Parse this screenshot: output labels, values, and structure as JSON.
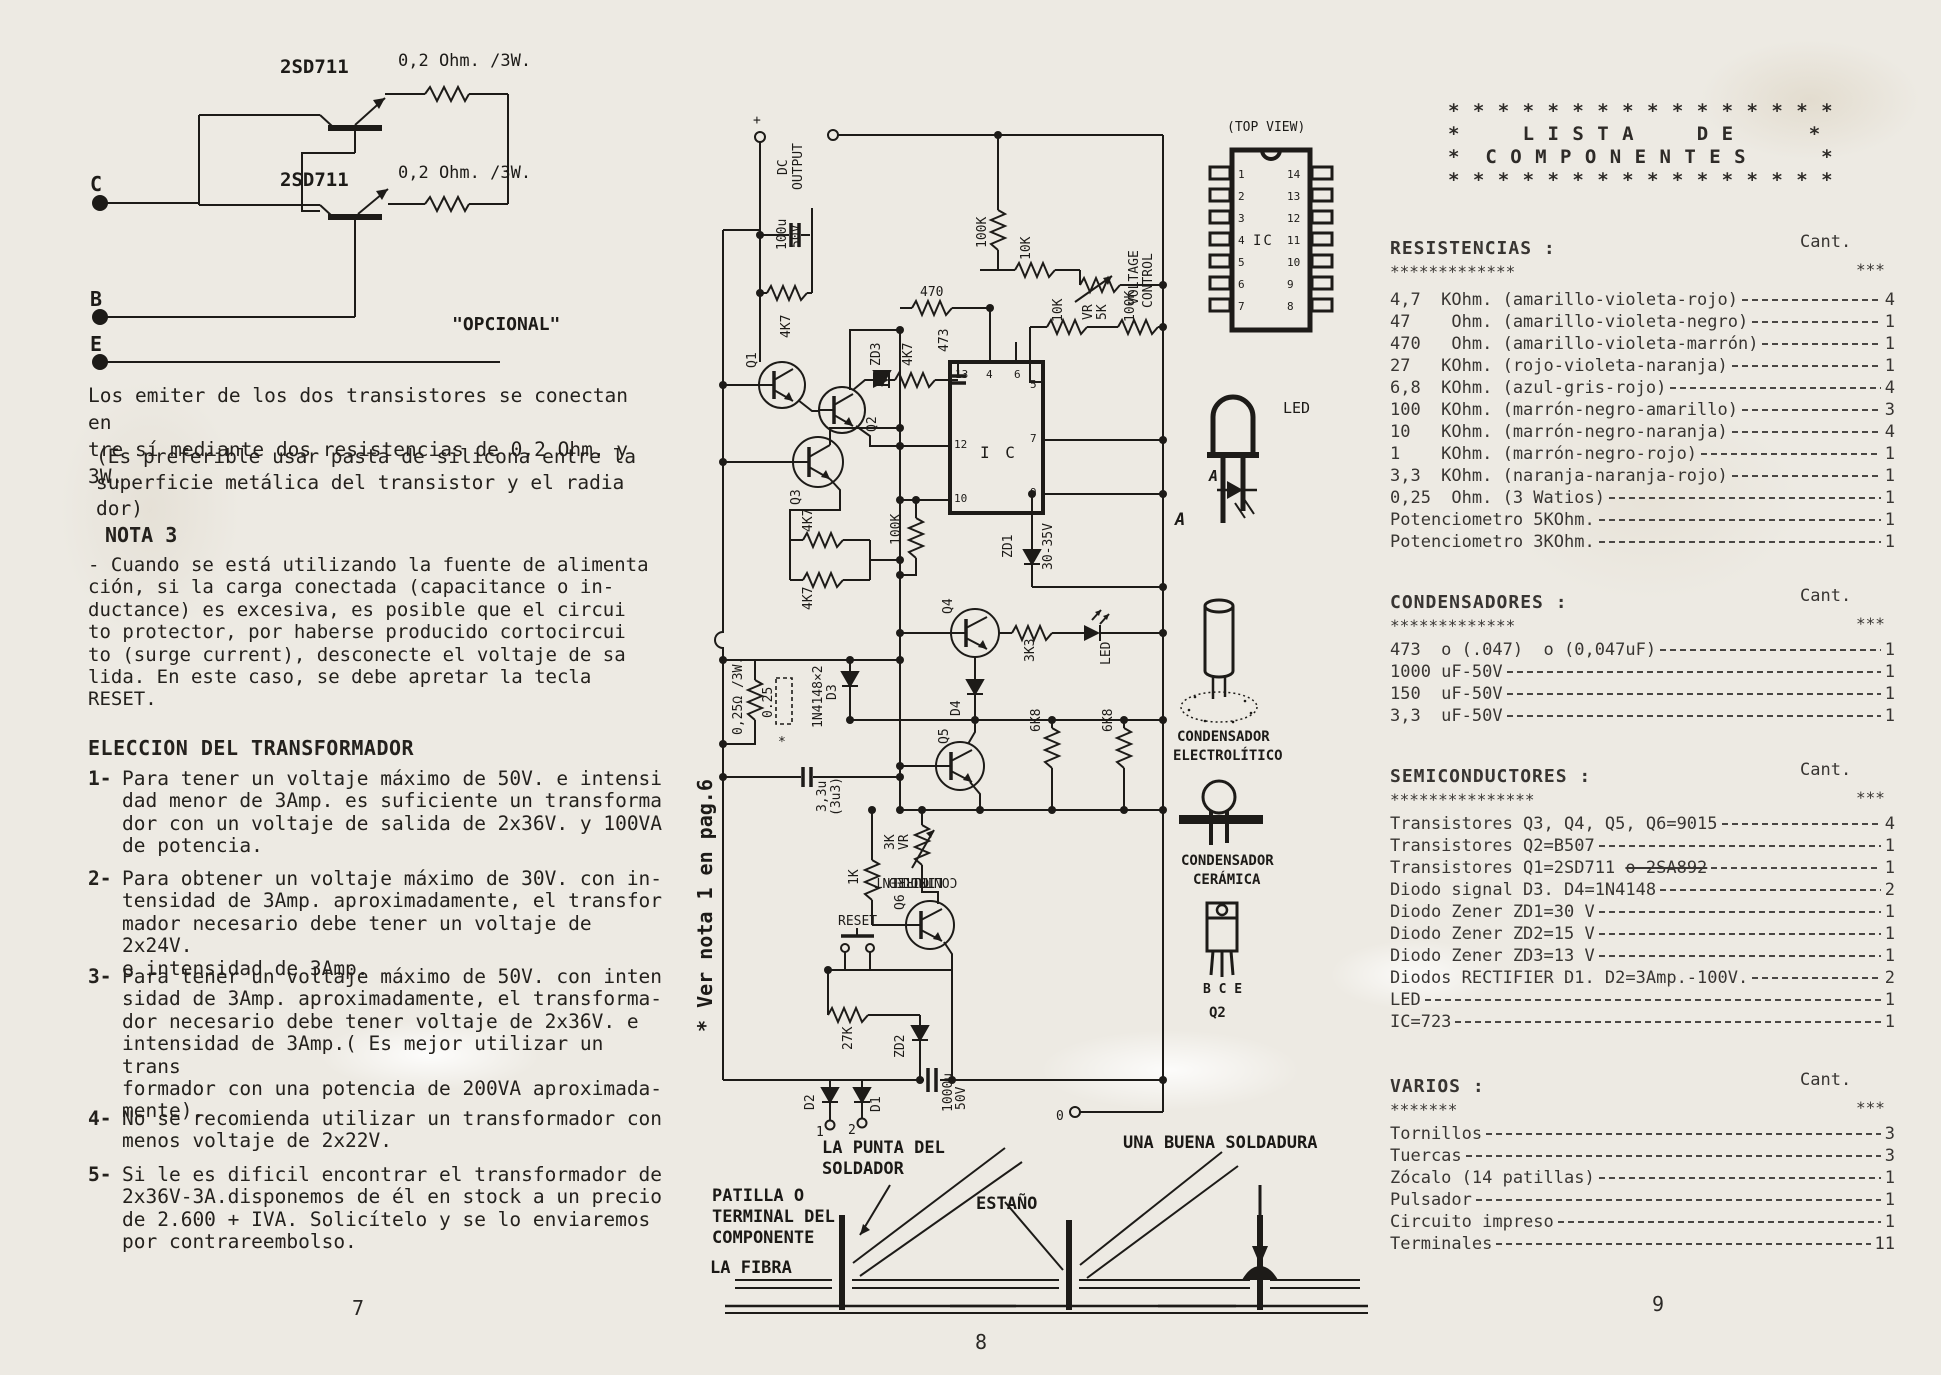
{
  "left_column": {
    "circuit": {
      "q_top": "2SD711",
      "q_bottom": "2SD711",
      "r_top": "0,2 Ohm. /3W.",
      "r_bottom": "0,2 Ohm. /3W.",
      "term_c": "C",
      "term_b": "B",
      "term_e": "E",
      "caption": "\"OPCIONAL\""
    },
    "para1": "Los emiter de los dos transistores se conectan en\ntre sí mediante dos resistencias de 0,2 Ohm. y 3W.",
    "para2": "(Es preferible usar pasta de silicona entre la\n superficie metálica del transistor y el radia\n dor)",
    "nota3_title": "NOTA 3",
    "nota3_body": "- Cuando se está utilizando la fuente de alimenta\n  ción, si la carga conectada (capacitance o in-\n  ductance) es excesiva, es posible que el circui\n  to protector, por haberse producido cortocircui\n  to (surge current), desconecte el voltaje de sa\n  lida. En este caso, se debe apretar la tecla\n  RESET.",
    "eleccion_title": "ELECCION DEL TRANSFORMADOR",
    "items": [
      {
        "num": "1-",
        "text": "Para tener un voltaje máximo de 50V. e intensi\ndad menor de 3Amp. es suficiente un transforma\ndor con un voltaje de salida de 2x36V. y 100VA\nde potencia."
      },
      {
        "num": "2-",
        "text": "Para obtener un voltaje máximo de 30V. con in-\ntensidad de 3Amp. aproximadamente, el transfor\nmador necesario debe tener un voltaje de 2x24V.\ne intensidad de 3Amp."
      },
      {
        "num": "3-",
        "text": "Para tener un voltaje máximo de 50V. con inten\nsidad de 3Amp. aproximadamente, el transforma-\ndor necesario debe tener voltaje de 2x36V. e\nintensidad de 3Amp.( Es mejor utilizar un trans\nformador con una potencia de 200VA aproximada-\nmente)."
      },
      {
        "num": "4-",
        "text": "No se recomienda utilizar un transformador con\nmenos voltaje de 2x22V."
      },
      {
        "num": "5-",
        "text": "Si le es dificil encontrar el transformador de\n2x36V-3A.disponemos de él en stock a un precio\nde 2.600 + IVA. Solicítelo y se lo enviaremos\npor contrareembolso."
      }
    ],
    "page_number": "7"
  },
  "schematic": {
    "labels": {
      "plus": "+",
      "dc1": "DC",
      "dc2": "OUTPUT",
      "c100u": "100u",
      "c100v": "50V",
      "r4k7_top": "4K7",
      "q1": "Q1",
      "q2": "Q2",
      "zd3": "ZD3",
      "r4k7_zd3": "4K7",
      "c473": "473",
      "r470": "470",
      "r100k_a": "100K",
      "r10k_a": "10K",
      "volt1": "VOLTAGE",
      "volt2": "CONTROL",
      "vr_a": "VR",
      "vr_a2": "5K",
      "r100k_b": "100K",
      "r10k_b": "10K",
      "ic": "I C",
      "p13": "13",
      "p4": "4",
      "p6": "6",
      "p5": "5",
      "p7": "7",
      "p9": "9",
      "p12": "12",
      "p10": "10",
      "q3": "Q3",
      "r4k7_a": "4K7",
      "r4k7_b": "4K7",
      "r100k_c": "100K",
      "zd1": "ZD1",
      "zd1v": "30-35V",
      "q4": "Q4",
      "r3k3": "3K3",
      "led": "LED",
      "r6k8_a": "6K8",
      "r6k8_b": "6K8",
      "q5": "Q5",
      "c33u": "3,3u",
      "c33u2": "(3u3)",
      "vr_b": "VR",
      "vr_b2": "3K",
      "r1k": "1K",
      "cur1": "CURRENT",
      "cur2": "LIMITED",
      "cur3": "CONTROL",
      "q6": "Q6",
      "reset": "RESET",
      "r27k": "27K",
      "zd2": "ZD2",
      "r025": "0,25Ω /3W.",
      "r025b": "0.25",
      "ast": "*",
      "d3lbl": "1N4148×2",
      "d3": "D3",
      "d4": "D4",
      "d2": "D2",
      "d1": "D1",
      "t1": "1",
      "t2": "2",
      "c1000": "1000u",
      "c1000v": "50V",
      "t0": "0",
      "note": "* Ver nota 1 en pag.6"
    }
  },
  "pictograms": {
    "top_view": "(TOP VIEW)",
    "ic": "IC",
    "pins_left": [
      "1",
      "2",
      "3",
      "4",
      "5",
      "6",
      "7"
    ],
    "pins_right": [
      "14",
      "13",
      "12",
      "11",
      "10",
      "9",
      "8"
    ],
    "led": "LED",
    "a1": "A",
    "a2": "A",
    "elec1": "CONDENSADOR",
    "elec2": "ELECTROLÍTICO",
    "cer1": "CONDENSADOR",
    "cer2": "CERÁMICA",
    "bce": "B C E",
    "q2": "Q2"
  },
  "soldering": {
    "tip": "LA PUNTA DEL\nSOLDADOR",
    "lead": "PATILLA O\nTERMINAL DEL\nCOMPONENTE",
    "tin": "ESTAÑO",
    "fiber": "LA FIBRA",
    "good": "UNA BUENA SOLDADURA",
    "page_number": "8"
  },
  "component_list": {
    "header": "* * * * * * * * * * * * * * * *\n*     L I S T A     D E      *\n*  C O M P O N E N T E S      *\n* * * * * * * * * * * * * * * *",
    "cant_label": "Cant.",
    "cant_stars": "***",
    "sections": [
      {
        "title": "RESISTENCIAS :",
        "stars": "*************",
        "items": [
          {
            "label": "4,7  KOhm. (amarillo-violeta-rojo)",
            "qty": "4"
          },
          {
            "label": "47    Ohm. (amarillo-violeta-negro)",
            "qty": "1"
          },
          {
            "label": "470   Ohm. (amarillo-violeta-marrón)",
            "qty": "1"
          },
          {
            "label": "27   KOhm. (rojo-violeta-naranja)",
            "qty": "1"
          },
          {
            "label": "6,8  KOhm. (azul-gris-rojo)",
            "qty": "4"
          },
          {
            "label": "100  KOhm. (marrón-negro-amarillo)",
            "qty": "3"
          },
          {
            "label": "10   KOhm. (marrón-negro-naranja)",
            "qty": "4"
          },
          {
            "label": "1    KOhm. (marrón-negro-rojo)",
            "qty": "1"
          },
          {
            "label": "3,3  KOhm. (naranja-naranja-rojo)",
            "qty": "1"
          },
          {
            "label": "0,25  Ohm. (3 Watios)",
            "qty": "1"
          },
          {
            "label": "Potenciometro 5KOhm.",
            "qty": "1"
          },
          {
            "label": "Potenciometro 3KOhm.",
            "qty": "1"
          }
        ]
      },
      {
        "title": "CONDENSADORES :",
        "stars": "*************",
        "items": [
          {
            "label": "473  o (.047)  o (0,047uF)",
            "qty": "1"
          },
          {
            "label": "1000 uF-50V",
            "qty": "1"
          },
          {
            "label": "150  uF-50V",
            "qty": "1"
          },
          {
            "label": "3,3  uF-50V",
            "qty": "1"
          }
        ]
      },
      {
        "title": "SEMICONDUCTORES :",
        "stars": "***************",
        "items": [
          {
            "label": "Transistores Q3, Q4, Q5, Q6=9015",
            "qty": "4"
          },
          {
            "label": "Transistores Q2=B507",
            "qty": "1"
          },
          {
            "label": "Transistores Q1=2SD711 ",
            "struck": "o 2SA892",
            "qty": "1"
          },
          {
            "label": "Diodo signal D3. D4=1N4148",
            "qty": "2"
          },
          {
            "label": "Diodo Zener ZD1=30 V",
            "qty": "1"
          },
          {
            "label": "Diodo Zener ZD2=15 V",
            "qty": "1"
          },
          {
            "label": "Diodo Zener ZD3=13 V",
            "qty": "1"
          },
          {
            "label": "Diodos RECTIFIER D1. D2=3Amp.-100V.",
            "qty": "2"
          },
          {
            "label": "LED",
            "qty": "1"
          },
          {
            "label": "IC=723",
            "qty": "1"
          }
        ]
      },
      {
        "title": "VARIOS :",
        "stars": "*******",
        "items": [
          {
            "label": "Tornillos",
            "qty": "3"
          },
          {
            "label": "Tuercas",
            "qty": "3"
          },
          {
            "label": "Zócalo (14 patillas)",
            "qty": "1"
          },
          {
            "label": "Pulsador",
            "qty": "1"
          },
          {
            "label": "Circuito impreso",
            "qty": "1"
          },
          {
            "label": "Terminales",
            "qty": "11"
          }
        ]
      }
    ],
    "page_number": "9"
  }
}
